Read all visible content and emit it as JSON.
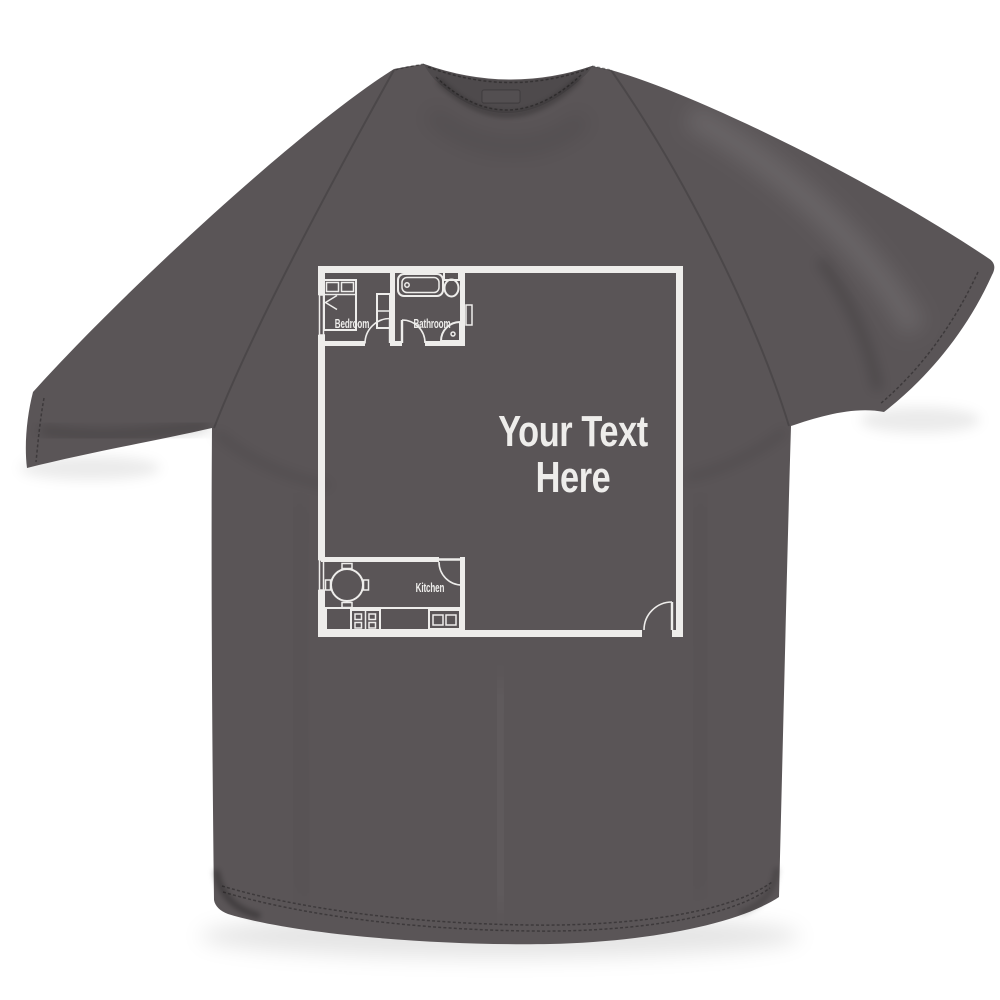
{
  "colors": {
    "background": "#ffffff",
    "shirt": "#5a5557",
    "collar_band": "#4e4a4c",
    "print": "#f3f2f0"
  },
  "product": {
    "type": "t-shirt front flat-lay photo",
    "shirt_color_name": "charcoal grey",
    "print_description": "white one-bedroom apartment floor plan printed on chest"
  },
  "floor_plan": {
    "labels": {
      "bedroom": "Bedroom",
      "bathroom": "Bathroom",
      "kitchen": "Kitchen"
    },
    "custom_text": {
      "line1": "Your Text",
      "line2": "Here"
    },
    "icons": [
      "bed",
      "pillows",
      "duvet-fold",
      "wardrobe",
      "window",
      "bathtub",
      "toilet",
      "corner-basin",
      "radiator",
      "dining-table",
      "chairs",
      "kitchen-counter",
      "four-ring-hob",
      "double-sink",
      "room-door-swings",
      "entry-door-swing"
    ]
  }
}
